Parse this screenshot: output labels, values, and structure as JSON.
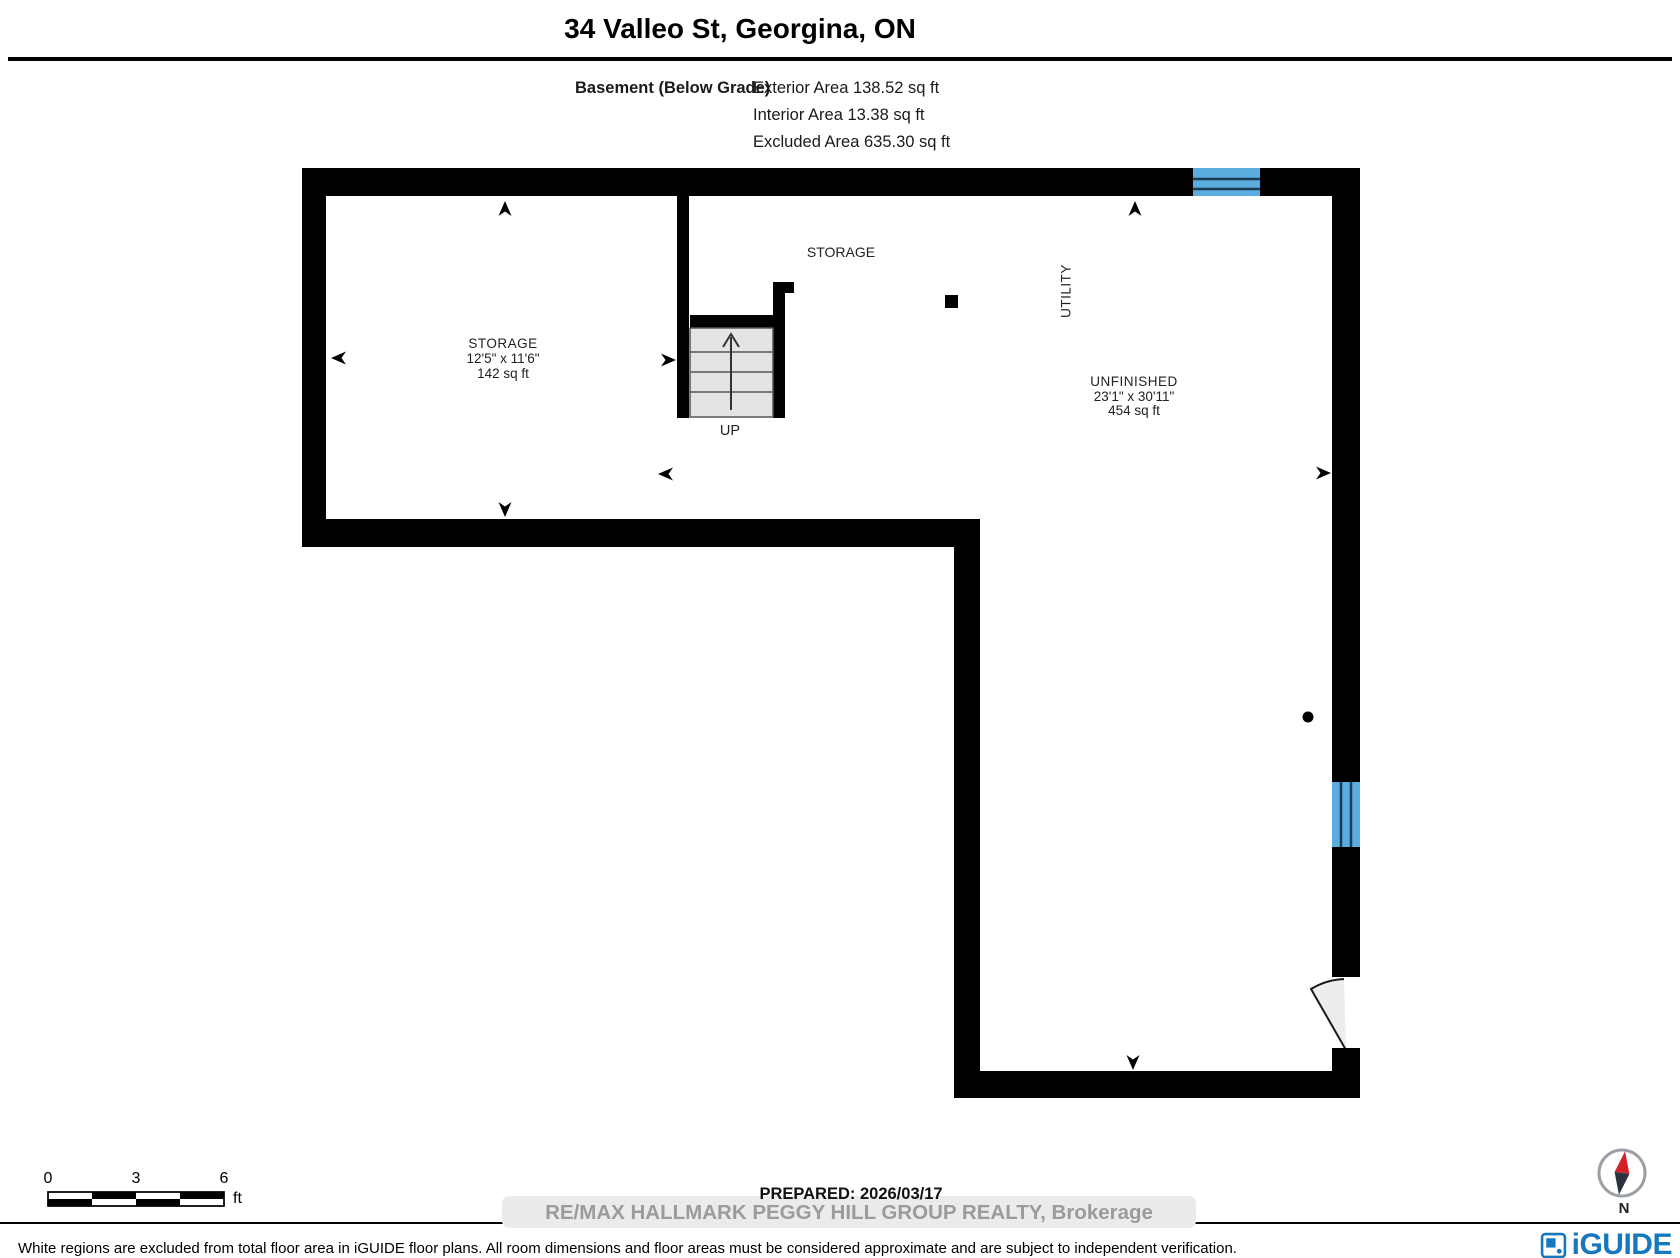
{
  "header": {
    "title": "34 Valleo St, Georgina, ON",
    "floor_label": "Basement (Below Grade)",
    "area_lines": [
      "Exterior Area 138.52 sq ft",
      "Interior Area 13.38 sq ft",
      "Excluded Area 635.30 sq ft"
    ]
  },
  "plan": {
    "rooms": {
      "storage": {
        "name": "STORAGE",
        "dims": "12'5\" x 11'6\"",
        "area": "142 sq ft"
      },
      "storage_open": {
        "name": "STORAGE"
      },
      "utility": {
        "name": "UTILITY"
      },
      "unfinished": {
        "name": "UNFINISHED",
        "dims": "23'1\" x 30'11\"",
        "area": "454 sq ft"
      }
    },
    "stairs_label": "UP",
    "colors": {
      "wall": "#000000",
      "window_fill": "#5BACDF",
      "window_line": "#1A3C55",
      "stair_fill": "#E4E4E4",
      "door_swing_fill": "#EDEDED"
    }
  },
  "scale_bar": {
    "ticks": [
      "0",
      "3",
      "6"
    ],
    "unit": "ft"
  },
  "compass": {
    "label": "N",
    "needle_north": "#D2232A",
    "needle_south": "#2A333E"
  },
  "footer": {
    "prepared": "PREPARED: 2026/03/17",
    "watermark": "RE/MAX HALLMARK PEGGY HILL GROUP REALTY, Brokerage",
    "disclaimer": "White regions are excluded from total floor area in iGUIDE floor plans. All room dimensions and floor areas must be considered approximate and are subject to independent verification.",
    "brand": "iGUIDE",
    "brand_color": "#1878BE"
  }
}
